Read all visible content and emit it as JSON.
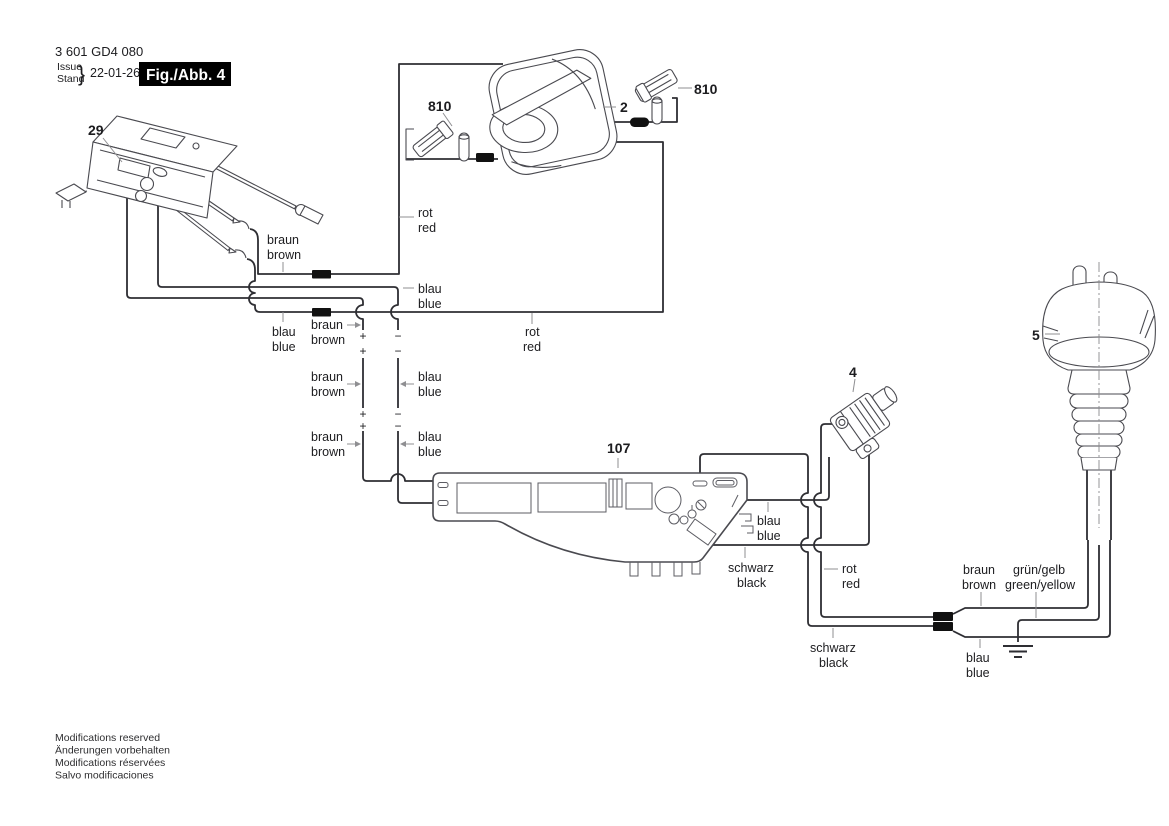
{
  "header": {
    "part_number": "3 601 GD4 080",
    "issue": "Issue",
    "stand": "Stand",
    "brace": "}",
    "date": "22-01-26",
    "figure": "Fig./Abb. 4"
  },
  "parts": {
    "switch": "29",
    "brush_left": "810",
    "field": "2",
    "brush_right": "810",
    "plug": "5",
    "connector": "4",
    "board": "107"
  },
  "wire_labels": {
    "rot": "rot",
    "red": "red",
    "braun": "braun",
    "brown": "brown",
    "blau": "blau",
    "blue": "blue",
    "schwarz": "schwarz",
    "black": "black",
    "gruen_gelb": "grün/gelb",
    "green_yellow": "green/yellow"
  },
  "polarity": {
    "plus": "+",
    "minus": "−"
  },
  "footer": {
    "line1": "Modifications reserved",
    "line2": "Änderungen vorbehalten",
    "line3": "Modifications réservées",
    "line4": "Salvo modificaciones"
  },
  "colors": {
    "wire": "#2e2e33",
    "component_line": "#4a4a50",
    "connector_block": "#111111",
    "figure_box": "#000000",
    "background": "#ffffff"
  }
}
